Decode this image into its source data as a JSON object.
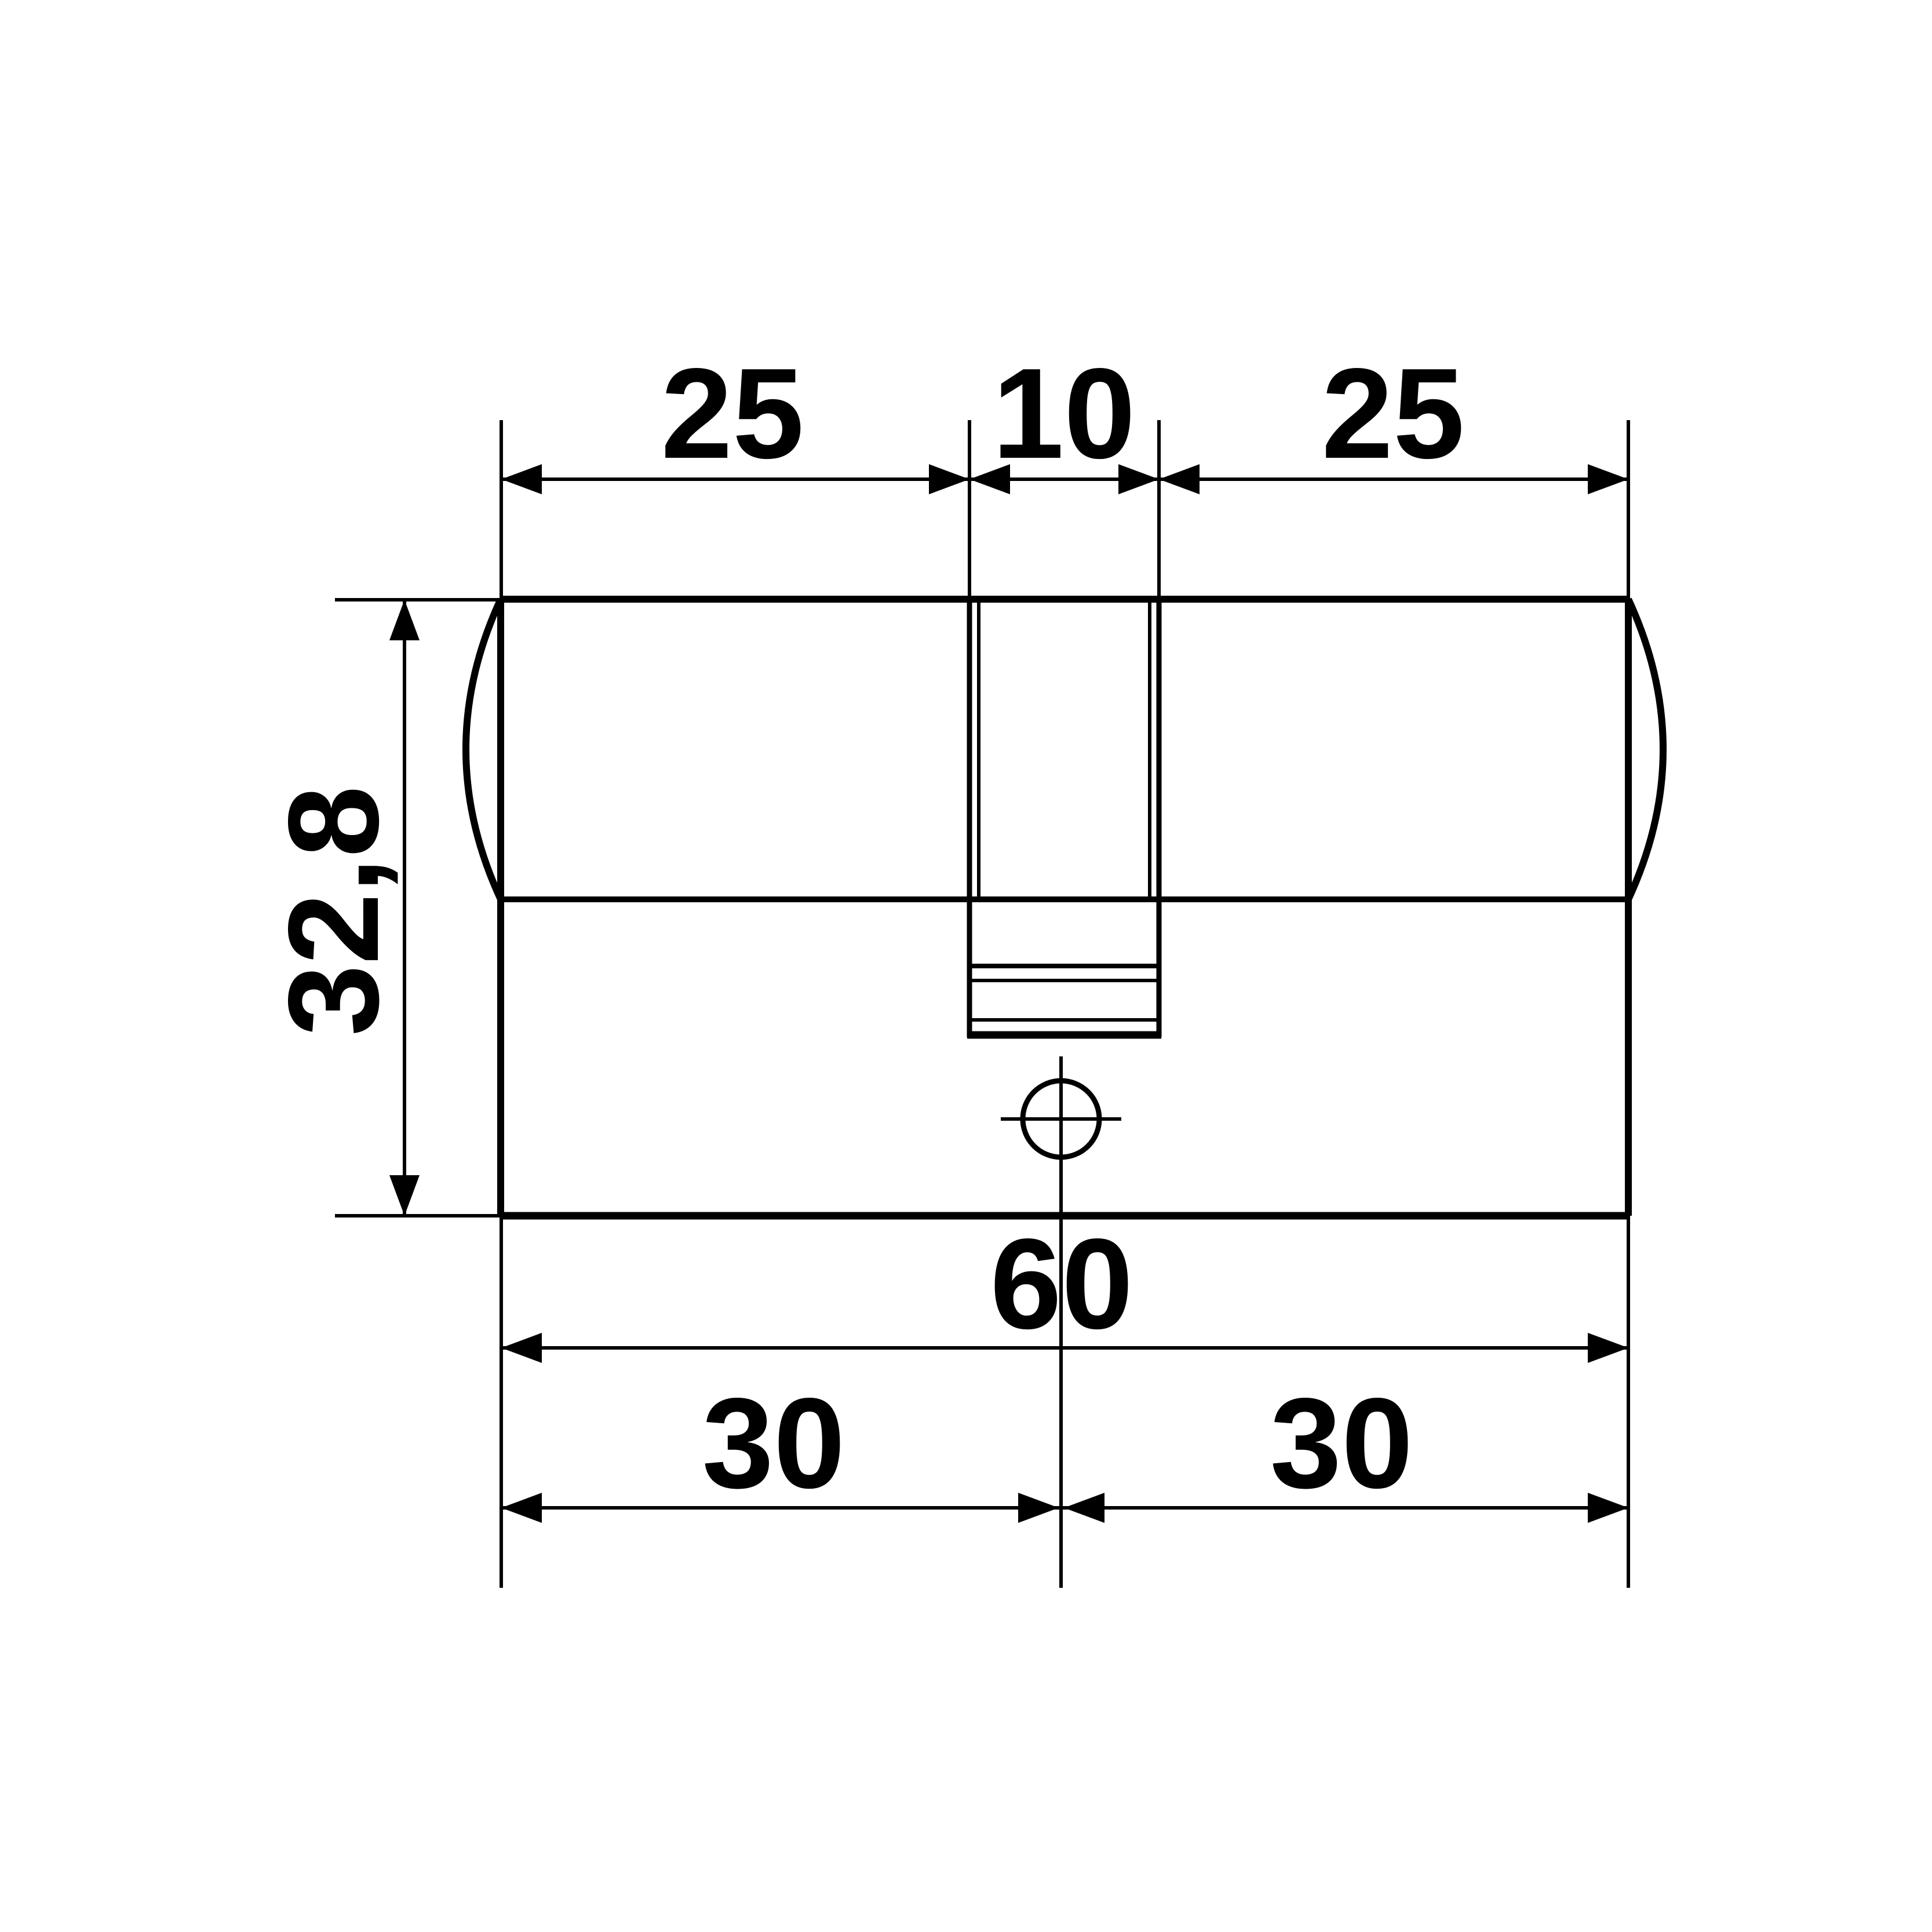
{
  "colors": {
    "background": "#ffffff",
    "line": "#000000",
    "text": "#000000"
  },
  "dimensions": {
    "top_left": "25",
    "top_middle": "10",
    "top_right": "25",
    "height": "32,8",
    "bottom_total": "60",
    "bottom_left": "30",
    "bottom_right": "30"
  }
}
